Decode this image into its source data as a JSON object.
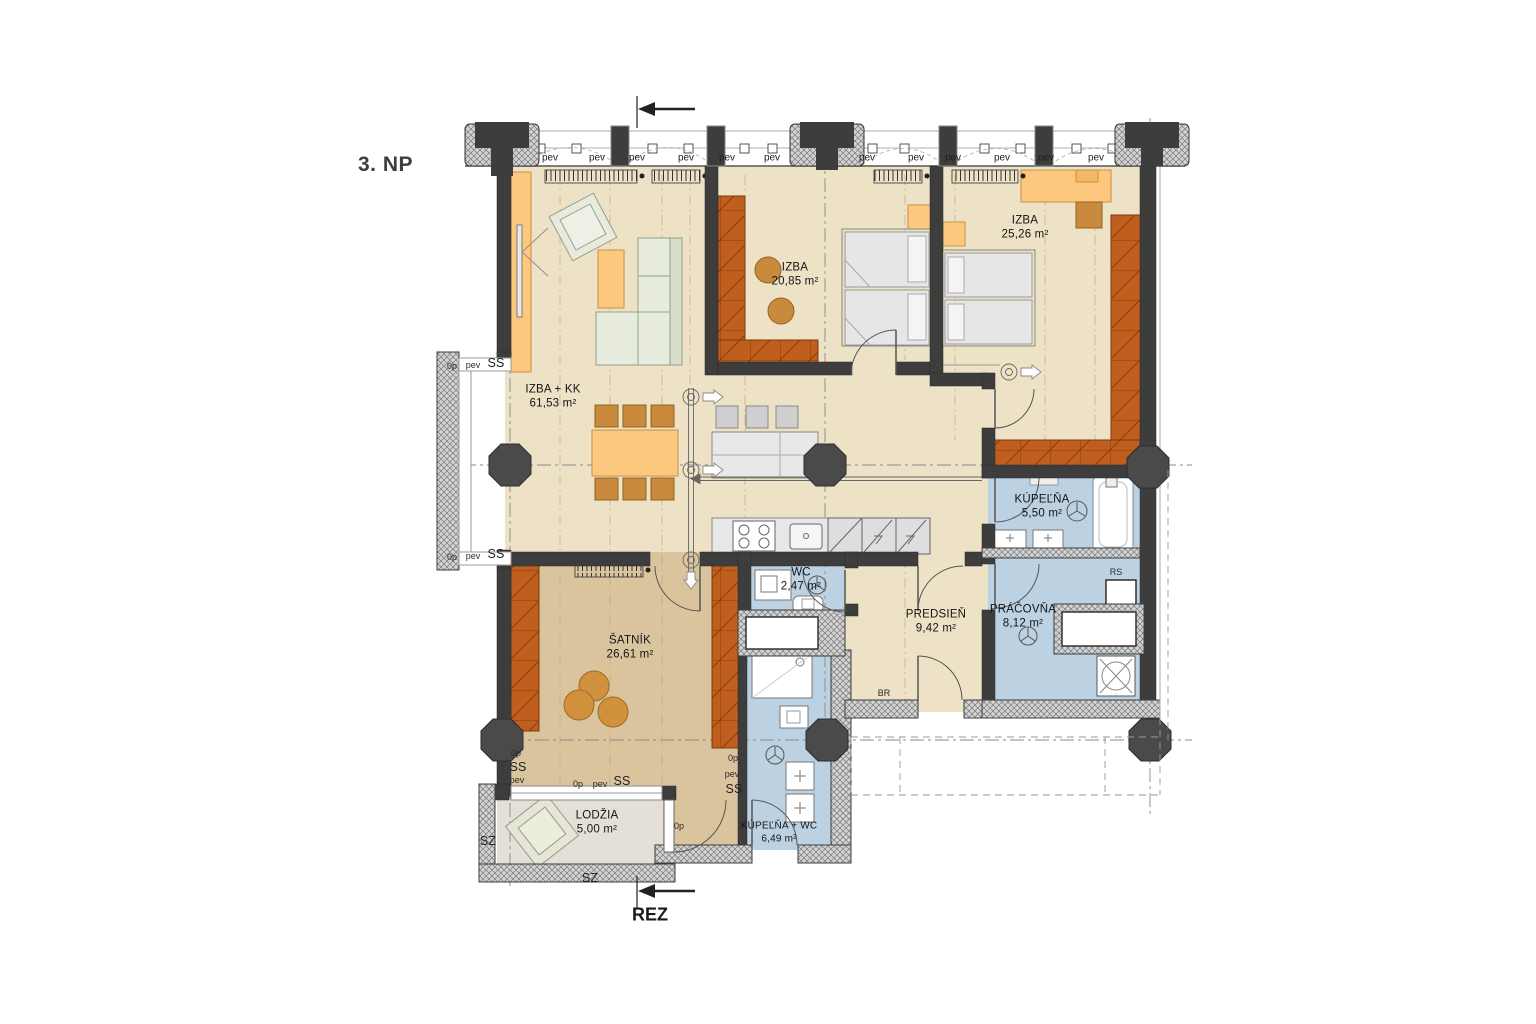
{
  "title": "3. NP",
  "section_label": "REZ",
  "compass_label": "SZ",
  "window_labels": {
    "pev": "pev",
    "ss": "SS",
    "op": "0p"
  },
  "tags": {
    "rs": "RS",
    "br": "BR"
  },
  "rooms": [
    {
      "id": "izba-kk",
      "name": "IZBA + KK",
      "area": "61,53 m²"
    },
    {
      "id": "izba-1",
      "name": "IZBA",
      "area": "20,85 m²"
    },
    {
      "id": "izba-2",
      "name": "IZBA",
      "area": "25,26 m²"
    },
    {
      "id": "kupelna",
      "name": "KÚPEĽŇA",
      "area": "5,50 m²"
    },
    {
      "id": "wc",
      "name": "WC",
      "area": "2,47 m²"
    },
    {
      "id": "predsien",
      "name": "PREDSIEŇ",
      "area": "9,42 m²"
    },
    {
      "id": "pracovna",
      "name": "PRÁČOVŇA",
      "area": "8,12 m²"
    },
    {
      "id": "satnik",
      "name": "ŠATNÍK",
      "area": "26,61 m²"
    },
    {
      "id": "kupelna-wc",
      "name": "KÚPEĽŇA + WC",
      "area": "6,49 m²"
    },
    {
      "id": "lodzia",
      "name": "LODŽIA",
      "area": "5,00 m²"
    }
  ],
  "colors": {
    "wall": "#3d3d3d",
    "floor_beige": "#EDE1C6",
    "floor_tan": "#D9C49E",
    "floor_blue": "#BCD2E3",
    "floor_loggia": "#E4E0D8",
    "furniture_orange": "#FBC87E",
    "furniture_brown": "#C98A3D",
    "wardrobe_rust": "#C05E1E"
  }
}
